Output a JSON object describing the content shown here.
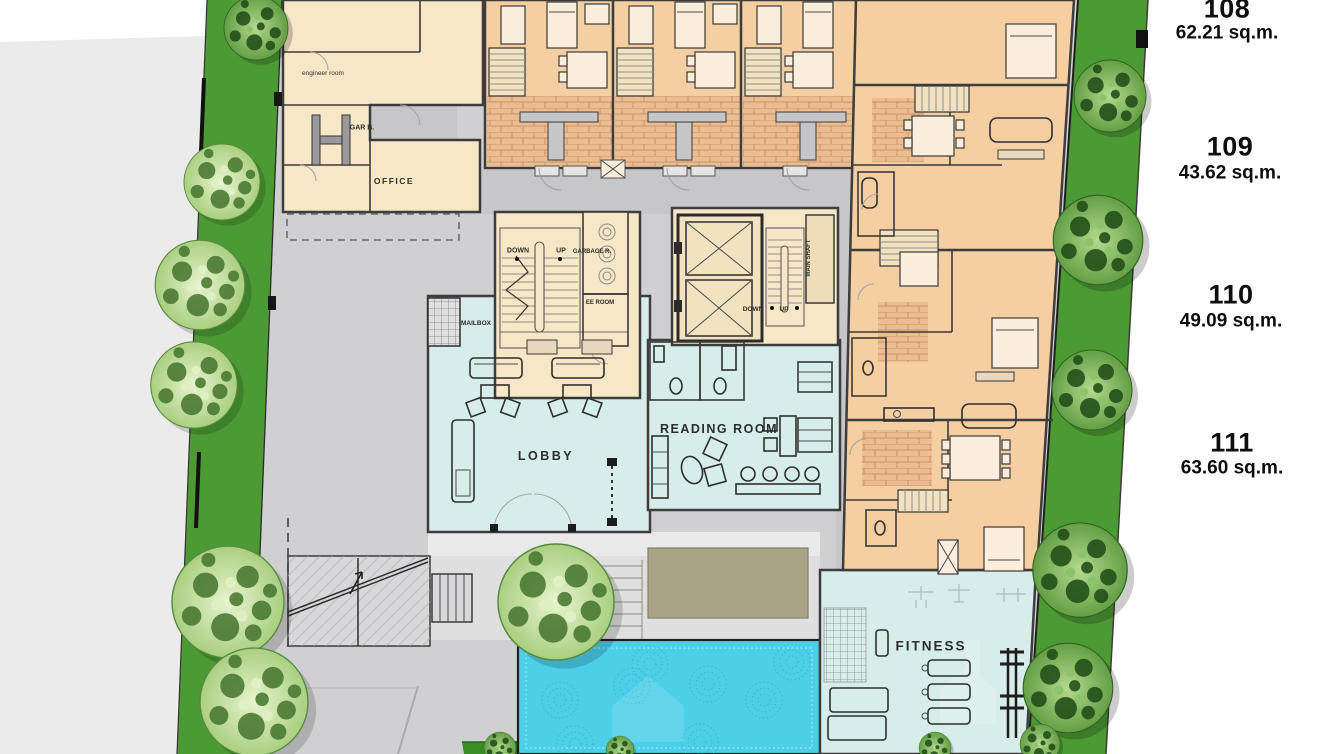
{
  "plan": {
    "rooms": {
      "engineer_room": "engineer room",
      "gar_b": "GAR B.",
      "office": "OFFICE",
      "stairs_down": "DOWN",
      "stairs_up": "UP",
      "garbage_room": "GARBAGE R.",
      "ee_room": "EE ROOM",
      "mailbox": "MAILBOX",
      "elev_down": "DOWN",
      "elev_up": "UP",
      "main_shaft": "MAIN SHAFT",
      "lobby": "LOBBY",
      "reading_room": "READING ROOM",
      "fitness": "FITNESS"
    },
    "units": [
      {
        "number": "108",
        "area": "62.21 sq.m."
      },
      {
        "number": "109",
        "area": "43.62 sq.m."
      },
      {
        "number": "110",
        "area": "49.09 sq.m."
      },
      {
        "number": "111",
        "area": "63.60 sq.m."
      }
    ],
    "colors": {
      "grass": "#4c9a33",
      "water": "#4ccfe9",
      "unit_fill": "#f5cfa2",
      "common_fill": "#d6edeb",
      "cream_fill": "#f8e7c6",
      "deck": "#a9a488",
      "site": "#d0d0d2"
    }
  }
}
